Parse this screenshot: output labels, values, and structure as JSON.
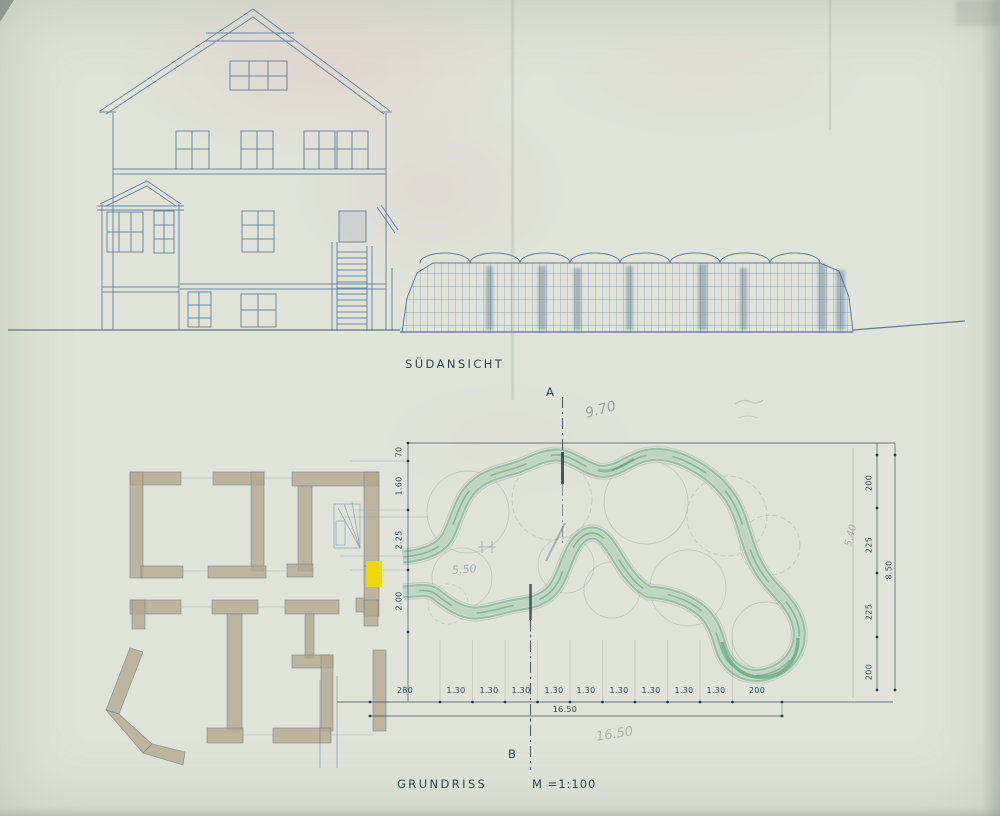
{
  "drawing": {
    "elevation_title": "SÜDANSICHT",
    "plan_title": "GRUNDRISS",
    "plan_scale": "M =1:100",
    "section": {
      "top": "A",
      "bottom": "B"
    }
  },
  "dims": {
    "bottom": [
      "280",
      "1.30",
      "1.30",
      "1.30",
      "1.30",
      "1.30",
      "1.30",
      "1.30",
      "1.30",
      "1.30",
      "200"
    ],
    "bottom_total": "16.50",
    "left": [
      "70",
      "1.60",
      "2.25",
      "2.00"
    ],
    "right": [
      "200",
      "225",
      "225",
      "200"
    ],
    "right_total": "8.50"
  },
  "handwritten": {
    "h970": "9.70",
    "h550": "5.50",
    "h1650": "16.50",
    "h540": "5.40"
  },
  "colors": {
    "paper": "#dfe3d8",
    "ink": "#2e4456",
    "blue_pencil": "#4a6f9d",
    "wall_tan": "#b3a78c",
    "path_green": "#4f9e74",
    "highlight_yellow": "#f2d900",
    "pencil_grey": "#8a9196"
  }
}
